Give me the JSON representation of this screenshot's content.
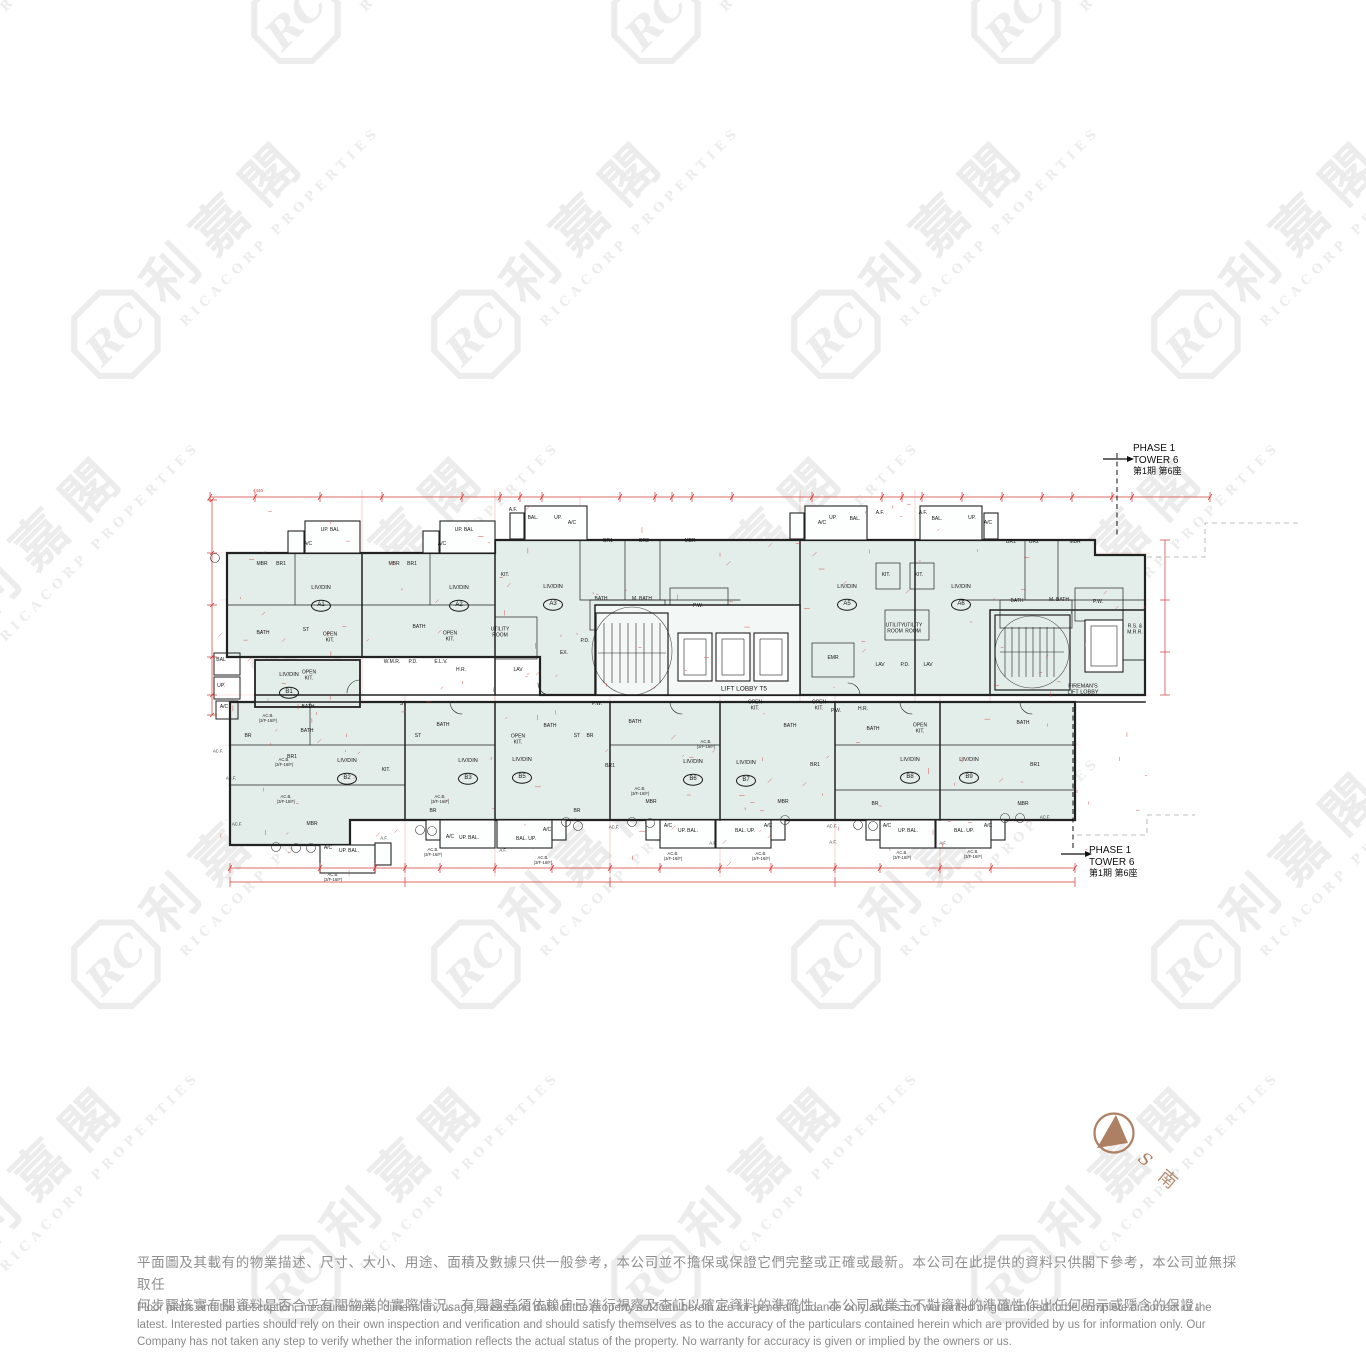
{
  "watermark": {
    "monogram": "RC",
    "chinese": "利嘉閣",
    "english": "RICACORP PROPERTIES"
  },
  "phase": [
    "PHASE 1",
    "TOWER 6",
    "第1期 第6座"
  ],
  "compass": {
    "s": "S",
    "south": "南",
    "color": "#ae8063"
  },
  "colors": {
    "unit_fill": "#e3edea",
    "lobby_fill": "#f3f7f5",
    "wall": "#222222",
    "dimension_red": "#d03b35",
    "disclaimer_gray": "#8f8f8f"
  },
  "plan": {
    "liv_din_label": "LIV/DIN",
    "units": [
      {
        "name": "A1",
        "x": 321,
        "y": 598
      },
      {
        "name": "A2",
        "x": 459,
        "y": 598
      },
      {
        "name": "A3",
        "x": 553,
        "y": 597
      },
      {
        "name": "A5",
        "x": 847,
        "y": 597
      },
      {
        "name": "A6",
        "x": 961,
        "y": 597
      },
      {
        "name": "B1",
        "x": 289,
        "y": 685
      },
      {
        "name": "B2",
        "x": 347,
        "y": 771
      },
      {
        "name": "B3",
        "x": 468,
        "y": 771
      },
      {
        "name": "B5",
        "x": 522,
        "y": 770
      },
      {
        "name": "B6",
        "x": 693,
        "y": 772
      },
      {
        "name": "B7",
        "x": 746,
        "y": 773
      },
      {
        "name": "B8",
        "x": 910,
        "y": 770
      },
      {
        "name": "B9",
        "x": 969,
        "y": 770
      }
    ],
    "rooms": [
      {
        "t": "UP. BAL",
        "x": 330,
        "y": 531
      },
      {
        "t": "A/C",
        "x": 308,
        "y": 545
      },
      {
        "t": "MBR",
        "x": 262,
        "y": 565
      },
      {
        "t": "BR1",
        "x": 281,
        "y": 565
      },
      {
        "t": "BATH",
        "x": 263,
        "y": 634
      },
      {
        "t": "ST",
        "x": 306,
        "y": 631
      },
      {
        "t": "OPEN|KIT.",
        "x": 330,
        "y": 638
      },
      {
        "t": "UP. BAL",
        "x": 464,
        "y": 531
      },
      {
        "t": "A/C",
        "x": 442,
        "y": 545
      },
      {
        "t": "MBR",
        "x": 394,
        "y": 565
      },
      {
        "t": "BR1",
        "x": 412,
        "y": 565
      },
      {
        "t": "BATH",
        "x": 419,
        "y": 628
      },
      {
        "t": "OPEN|KIT.",
        "x": 450,
        "y": 637
      },
      {
        "t": "UTILITY|ROOM",
        "x": 500,
        "y": 633
      },
      {
        "t": "W.M.R.",
        "x": 392,
        "y": 663
      },
      {
        "t": "P.D.",
        "x": 413,
        "y": 663
      },
      {
        "t": "E.L.V.",
        "x": 441,
        "y": 663
      },
      {
        "t": "H.R.",
        "x": 461,
        "y": 671
      },
      {
        "t": "A.F.",
        "x": 513,
        "y": 511
      },
      {
        "t": "BAL.",
        "x": 533,
        "y": 519
      },
      {
        "t": "UP.",
        "x": 558,
        "y": 519
      },
      {
        "t": "A/C",
        "x": 572,
        "y": 524
      },
      {
        "t": "KIT.",
        "x": 505,
        "y": 576
      },
      {
        "t": "BR1",
        "x": 608,
        "y": 542
      },
      {
        "t": "BR2",
        "x": 644,
        "y": 542
      },
      {
        "t": "MBR",
        "x": 690,
        "y": 542
      },
      {
        "t": "BATH",
        "x": 601,
        "y": 600
      },
      {
        "t": "M. BATH",
        "x": 642,
        "y": 600
      },
      {
        "t": "P.W.",
        "x": 698,
        "y": 607
      },
      {
        "t": "P.D.",
        "x": 585,
        "y": 642
      },
      {
        "t": "EX.",
        "x": 564,
        "y": 654
      },
      {
        "t": "LAV",
        "x": 518,
        "y": 671
      },
      {
        "t": "LIFT LOBBY T5",
        "x": 744,
        "y": 689,
        "s": 6.5
      },
      {
        "t": "EMR",
        "x": 833,
        "y": 659
      },
      {
        "t": "A/C",
        "x": 822,
        "y": 524
      },
      {
        "t": "UP.",
        "x": 833,
        "y": 519
      },
      {
        "t": "BAL.",
        "x": 855,
        "y": 520
      },
      {
        "t": "A.F.",
        "x": 880,
        "y": 514
      },
      {
        "t": "KIT.",
        "x": 886,
        "y": 576
      },
      {
        "t": "KIT.",
        "x": 919,
        "y": 576
      },
      {
        "t": "UTILITY|ROOM",
        "x": 895,
        "y": 629
      },
      {
        "t": "UTILITY|ROOM",
        "x": 913,
        "y": 629
      },
      {
        "t": "LAV",
        "x": 880,
        "y": 666
      },
      {
        "t": "P.D.",
        "x": 905,
        "y": 666
      },
      {
        "t": "LAV",
        "x": 928,
        "y": 666
      },
      {
        "t": "A.F.",
        "x": 923,
        "y": 514
      },
      {
        "t": "BAL.",
        "x": 937,
        "y": 520
      },
      {
        "t": "UP.",
        "x": 972,
        "y": 519
      },
      {
        "t": "A/C",
        "x": 988,
        "y": 524
      },
      {
        "t": "BR1",
        "x": 1011,
        "y": 543
      },
      {
        "t": "BR2",
        "x": 1034,
        "y": 543
      },
      {
        "t": "MBR",
        "x": 1075,
        "y": 543
      },
      {
        "t": "BATH",
        "x": 1017,
        "y": 602
      },
      {
        "t": "M. BATH",
        "x": 1059,
        "y": 601
      },
      {
        "t": "P.W.",
        "x": 1098,
        "y": 603
      },
      {
        "t": "R.S. &|M.R.R.",
        "x": 1135,
        "y": 630
      },
      {
        "t": "FIREMAN'S|LIFT LOBBY",
        "x": 1083,
        "y": 690,
        "s": 5.5
      },
      {
        "t": "BAL",
        "x": 221,
        "y": 661
      },
      {
        "t": "UP.",
        "x": 221,
        "y": 687
      },
      {
        "t": "A/C",
        "x": 224,
        "y": 708
      },
      {
        "t": "OPEN|KIT.",
        "x": 309,
        "y": 676
      },
      {
        "t": "BATH",
        "x": 308,
        "y": 708
      },
      {
        "t": "ST",
        "x": 403,
        "y": 705
      },
      {
        "t": "BR",
        "x": 248,
        "y": 737
      },
      {
        "t": "BATH",
        "x": 307,
        "y": 732
      },
      {
        "t": "BR1",
        "x": 292,
        "y": 758
      },
      {
        "t": "MBR",
        "x": 312,
        "y": 825
      },
      {
        "t": "UP. BAL.",
        "x": 349,
        "y": 852
      },
      {
        "t": "A/C",
        "x": 328,
        "y": 849
      },
      {
        "t": "ST",
        "x": 418,
        "y": 737
      },
      {
        "t": "BATH",
        "x": 443,
        "y": 726
      },
      {
        "t": "KIT.",
        "x": 386,
        "y": 771
      },
      {
        "t": "BR",
        "x": 433,
        "y": 812
      },
      {
        "t": "UP. BAL.",
        "x": 469,
        "y": 839
      },
      {
        "t": "A/C",
        "x": 450,
        "y": 838
      },
      {
        "t": "OPEN|KIT.",
        "x": 518,
        "y": 740
      },
      {
        "t": "BATH",
        "x": 550,
        "y": 727
      },
      {
        "t": "ST",
        "x": 577,
        "y": 737
      },
      {
        "t": "BR",
        "x": 590,
        "y": 737
      },
      {
        "t": "P.W.",
        "x": 597,
        "y": 705
      },
      {
        "t": "BR1",
        "x": 610,
        "y": 767
      },
      {
        "t": "BR",
        "x": 577,
        "y": 812
      },
      {
        "t": "MBR",
        "x": 651,
        "y": 803
      },
      {
        "t": "BAL. UP.",
        "x": 526,
        "y": 840
      },
      {
        "t": "A/C",
        "x": 547,
        "y": 831
      },
      {
        "t": "BATH",
        "x": 635,
        "y": 723
      },
      {
        "t": "OPEN|KIT.",
        "x": 755,
        "y": 706
      },
      {
        "t": "OPEN|KIT.",
        "x": 819,
        "y": 706
      },
      {
        "t": "BATH",
        "x": 790,
        "y": 727
      },
      {
        "t": "BR1",
        "x": 815,
        "y": 766
      },
      {
        "t": "UP. BAL.",
        "x": 688,
        "y": 832
      },
      {
        "t": "BAL. UP.",
        "x": 745,
        "y": 832
      },
      {
        "t": "A/C",
        "x": 668,
        "y": 827
      },
      {
        "t": "A/C",
        "x": 768,
        "y": 827
      },
      {
        "t": "MBR",
        "x": 783,
        "y": 803
      },
      {
        "t": "P.W.",
        "x": 836,
        "y": 712
      },
      {
        "t": "H.R.",
        "x": 863,
        "y": 710
      },
      {
        "t": "BATH",
        "x": 873,
        "y": 730
      },
      {
        "t": "OPEN|KIT.",
        "x": 920,
        "y": 729
      },
      {
        "t": "BR",
        "x": 875,
        "y": 805
      },
      {
        "t": "UP. BAL.",
        "x": 908,
        "y": 832
      },
      {
        "t": "BAL. UP.",
        "x": 964,
        "y": 832
      },
      {
        "t": "A/C",
        "x": 887,
        "y": 827
      },
      {
        "t": "A/C",
        "x": 988,
        "y": 827
      },
      {
        "t": "BATH",
        "x": 1023,
        "y": 724
      },
      {
        "t": "BR1",
        "x": 1035,
        "y": 766
      },
      {
        "t": "MBR",
        "x": 1023,
        "y": 805
      }
    ],
    "notes": [
      {
        "t": "AC.B.|(3/F-16/F)",
        "x": 268,
        "y": 719
      },
      {
        "t": "AC.B.|(3/F-16/F)",
        "x": 284,
        "y": 763
      },
      {
        "t": "AC.B.|(3/F-16/F)",
        "x": 286,
        "y": 800
      },
      {
        "t": "AC.B.|(3/F-16/F)",
        "x": 333,
        "y": 878
      },
      {
        "t": "AC.B.|(3/F-16/F)",
        "x": 440,
        "y": 800
      },
      {
        "t": "AC.B.|(3/F-16/F)",
        "x": 433,
        "y": 853
      },
      {
        "t": "AC.B.|(3/F-16/F)",
        "x": 543,
        "y": 861
      },
      {
        "t": "AC.B.|(3/F-16/F)",
        "x": 640,
        "y": 792
      },
      {
        "t": "AC.B.|(3/F-16/F)",
        "x": 673,
        "y": 857
      },
      {
        "t": "AC.B.|(3/F-16/F)",
        "x": 706,
        "y": 745
      },
      {
        "t": "AC.B.|(3/F-16/F)",
        "x": 761,
        "y": 857
      },
      {
        "t": "AC.B.|(3/F-16/F)",
        "x": 902,
        "y": 856
      },
      {
        "t": "AC.B.|(3/F-16/F)",
        "x": 973,
        "y": 855
      },
      {
        "t": "AC.F.",
        "x": 218,
        "y": 752
      },
      {
        "t": "AC.F.",
        "x": 231,
        "y": 779
      },
      {
        "t": "AC.F.",
        "x": 237,
        "y": 825
      },
      {
        "t": "AC.F.",
        "x": 614,
        "y": 828
      },
      {
        "t": "AC.F.",
        "x": 832,
        "y": 827
      },
      {
        "t": "AC.F.",
        "x": 1045,
        "y": 818
      },
      {
        "t": "A.F.",
        "x": 384,
        "y": 839
      },
      {
        "t": "A.F.",
        "x": 503,
        "y": 851
      },
      {
        "t": "A.F.",
        "x": 713,
        "y": 844
      },
      {
        "t": "A.F.",
        "x": 833,
        "y": 843
      },
      {
        "t": "A.F.",
        "x": 943,
        "y": 844
      }
    ],
    "dims": [
      {
        "t": "4440",
        "x": 258,
        "y": 491
      }
    ]
  },
  "disclaimer": {
    "zh": [
      "平面圖及其載有的物業描述、尺寸、大小、用途、面積及數據只供一般參考，本公司並不擔保或保證它們完整或正確或最新。本公司在此提供的資料只供閣下參考，本公司並無採取任",
      "何步驟核實有關資料是否合乎有關物業的實際情況。有興趣者須依賴自己進行視察及查証以確定資料的準確性。本公司或業主不對資料的準確性作出任何明示或隱含的保證。"
    ],
    "en": [
      "Floor plans and the description, measurements, dimension, usage, areas and data of the property set forth herein are for general guidance only and Is not warranted or guaranteed to be complete or correct or the",
      "latest. Interested parties should rely on their own inspection and verification and should satisfy themselves as to the accuracy of the particulars contained herein which are provided by us for information only.  Our",
      "Company has not taken any step to verify whether the information reflects the actual status of the property.  No warranty for accuracy is given or implied by the owners or us."
    ]
  }
}
